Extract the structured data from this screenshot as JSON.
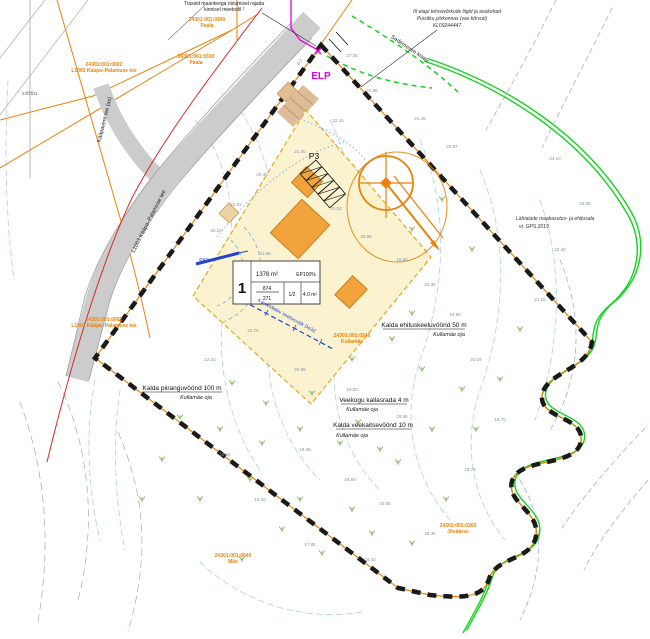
{
  "colors": {
    "cadastral_orange": "#E8820C",
    "boundary_black": "#1A1A1A",
    "plot_yellow": "#FBF3D0",
    "road_gray": "#CCCCCC",
    "stream_green": "#12D41F",
    "utility_blue": "#2244CC",
    "survey_magenta": "#E400E4",
    "protection_red": "#D42A2A",
    "contour_cyan": "#B5D6E6"
  },
  "plot_table": {
    "pos": "1",
    "area": "1378 m²",
    "ep": "EP100%",
    "frac_top": "874",
    "frac_bottom": "271",
    "floors": "1/2",
    "height": "4.0 m²"
  },
  "labels": [
    {
      "id": "note-crossing-line1",
      "t": "Trassid maanteega ristumisel rajada",
      "x": 224,
      "y": 5,
      "cls": "t-note"
    },
    {
      "id": "note-crossing-line2",
      "t": "kinnisel meetodil !",
      "x": 224,
      "y": 11,
      "cls": "t-note"
    },
    {
      "id": "note-utilities-line1",
      "t": "III etapi tehnovõrkude liigid ja asukohad",
      "x": 457,
      "y": 13,
      "cls": "t-noteit"
    },
    {
      "id": "note-utilities-line2",
      "t": "Puistiku piirkonnas (vas kõrvuti)",
      "x": 452,
      "y": 20,
      "cls": "t-noteit"
    },
    {
      "id": "note-utilities-line3",
      "t": "KL09244447",
      "x": 447,
      "y": 27,
      "cls": "t-noteit"
    },
    {
      "id": "cad-paala-1-code",
      "t": "24301:001:0300",
      "x": 207,
      "y": 21,
      "cls": "t-cad"
    },
    {
      "id": "cad-paala-1-name",
      "t": "Paala",
      "x": 207,
      "y": 27,
      "cls": "t-cad"
    },
    {
      "id": "cad-paala-2-code",
      "t": "24301:001:0310",
      "x": 196,
      "y": 58,
      "cls": "t-cad"
    },
    {
      "id": "cad-paala-2-name",
      "t": "Paala",
      "x": 196,
      "y": 64,
      "cls": "t-cad"
    },
    {
      "id": "cad-road-top-code",
      "t": "24301:001:0002",
      "x": 104,
      "y": 66,
      "cls": "t-cad"
    },
    {
      "id": "cad-road-top-name",
      "t": "L1003 Kääpa–Palamuse tee",
      "x": 104,
      "y": 72,
      "cls": "t-cad"
    },
    {
      "id": "cad-road-mid-code",
      "t": "24301:001:0002",
      "x": 104,
      "y": 321,
      "cls": "t-cad"
    },
    {
      "id": "cad-road-mid-name",
      "t": "L1003 Kääpa–Palamuse tee",
      "x": 104,
      "y": 327,
      "cls": "t-cad"
    },
    {
      "id": "cad-kullamae-code",
      "t": "24301:001:0246",
      "x": 352,
      "y": 337,
      "cls": "t-cad"
    },
    {
      "id": "cad-kullamae-name",
      "t": "Kullamäe",
      "x": 352,
      "y": 343,
      "cls": "t-cad"
    },
    {
      "id": "cad-mae-code",
      "t": "24301:001:0040",
      "x": 233,
      "y": 557,
      "cls": "t-cad"
    },
    {
      "id": "cad-mae-name",
      "t": "Mäe",
      "x": 233,
      "y": 563,
      "cls": "t-cad"
    },
    {
      "id": "cad-joeaarse-code",
      "t": "24301:001:0260",
      "x": 458,
      "y": 527,
      "cls": "t-cad"
    },
    {
      "id": "cad-joeaarse-name",
      "t": "Jõeäärse",
      "x": 458,
      "y": 533,
      "cls": "t-cad"
    },
    {
      "id": "zone-piirang-label",
      "t": "Kalda piiranguvöönd 100 m",
      "x": 182,
      "y": 390,
      "cls": "t-zone"
    },
    {
      "id": "zone-piirang-sub",
      "t": "Kullamäe oja",
      "x": 196,
      "y": 399,
      "cls": "t-zoneit"
    },
    {
      "id": "zone-ehituskeeld-label",
      "t": "Kalda ehituskeeluvöönd 50 m",
      "x": 424,
      "y": 327,
      "cls": "t-zone"
    },
    {
      "id": "zone-ehituskeeld-sub",
      "t": "Kullamäe oja",
      "x": 449,
      "y": 336,
      "cls": "t-zoneit"
    },
    {
      "id": "zone-kallasrada-label",
      "t": "Veekogu kallasrada 4 m",
      "x": 374,
      "y": 402,
      "cls": "t-zone"
    },
    {
      "id": "zone-kallasrada-sub",
      "t": "Kullamäe oja",
      "x": 362,
      "y": 411,
      "cls": "t-zoneit"
    },
    {
      "id": "zone-veekaitse-label",
      "t": "Kalda veekaitsevöönd 10 m",
      "x": 373,
      "y": 427,
      "cls": "t-zone"
    },
    {
      "id": "zone-veekaitse-sub",
      "t": "Kullamäe oja",
      "x": 352,
      "y": 437,
      "cls": "t-zoneit"
    },
    {
      "id": "note-adjacent-line1",
      "t": "Lähialade maakasutus- ja ehitusala",
      "x": 516,
      "y": 220,
      "cls": "t-noteit",
      "anchor": "start"
    },
    {
      "id": "note-adjacent-line2",
      "t": "vt. GPS.2019",
      "x": 519,
      "y": 228,
      "cls": "t-noteit",
      "anchor": "start"
    },
    {
      "id": "label-elp",
      "t": "ELP",
      "x": 321,
      "y": 79,
      "cls": "t-elp"
    },
    {
      "id": "label-p3",
      "t": "P3",
      "x": 314,
      "y": 159,
      "cls": "t-p3"
    },
    {
      "id": "label-pk3",
      "t": "PK3",
      "x": 204,
      "y": 262,
      "cls": "t-blue"
    },
    {
      "id": "road-name-kaapavere",
      "t": "Kääpavere tee (as)",
      "x": 106,
      "y": 120,
      "cls": "t-road",
      "r": -76
    },
    {
      "id": "road-name-l1003",
      "t": "L1003 Kääpa–Palamuse tee",
      "x": 150,
      "y": 222,
      "cls": "t-road",
      "r": -63
    },
    {
      "id": "pipe-veetorustik",
      "t": "Kavandatav veetorustik De32",
      "x": 286,
      "y": 317,
      "cls": "t-blue",
      "r": 29
    },
    {
      "id": "ditch-sademevee",
      "t": "Sademevee kraav",
      "x": 409,
      "y": 50,
      "cls": "t-road",
      "r": 34
    },
    {
      "id": "dim-07",
      "t": "0.7",
      "x": 301,
      "y": 63,
      "cls": "t-dim",
      "r": -47
    },
    {
      "id": "survey-ref",
      "t": "24/1511",
      "x": 22,
      "y": 95,
      "cls": "t-dim",
      "anchor": "start"
    }
  ],
  "spot_heights": [
    [
      27.35,
      352,
      57
    ],
    [
      21.96,
      372,
      92
    ],
    [
      21.45,
      420,
      120
    ],
    [
      20.87,
      452,
      148
    ],
    [
      22.15,
      338,
      122
    ],
    [
      21.3,
      300,
      153
    ],
    [
      20.45,
      262,
      176
    ],
    [
      21.62,
      236,
      206
    ],
    [
      20.12,
      216,
      232
    ],
    [
      21.02,
      336,
      210
    ],
    [
      20.66,
      366,
      238
    ],
    [
      19.85,
      402,
      261
    ],
    [
      20.3,
      430,
      286
    ],
    [
      19.56,
      455,
      316
    ],
    [
      21.75,
      253,
      332
    ],
    [
      22.31,
      210,
      361
    ],
    [
      20.95,
      300,
      371
    ],
    [
      19.2,
      352,
      391
    ],
    [
      18.95,
      402,
      418
    ],
    [
      19.45,
      305,
      451
    ],
    [
      18.6,
      350,
      481
    ],
    [
      18.2,
      260,
      501
    ],
    [
      19.02,
      225,
      456
    ],
    [
      17.85,
      310,
      546
    ],
    [
      18.42,
      370,
      561
    ],
    [
      20.18,
      476,
      361
    ],
    [
      19.7,
      500,
      421
    ],
    [
      18.75,
      470,
      471
    ],
    [
      21.15,
      540,
      301
    ],
    [
      22.4,
      560,
      251
    ],
    [
      23.05,
      585,
      205
    ],
    [
      24.1,
      555,
      160
    ],
    [
      20.55,
      385,
      505
    ],
    [
      19.35,
      430,
      535
    ],
    [
      21.88,
      265,
      255
    ]
  ],
  "vegetation_marks": [
    [
      180,
      420
    ],
    [
      220,
      432
    ],
    [
      262,
      446
    ],
    [
      300,
      432
    ],
    [
      340,
      446
    ],
    [
      380,
      452
    ],
    [
      250,
      482
    ],
    [
      200,
      502
    ],
    [
      300,
      502
    ],
    [
      352,
      512
    ],
    [
      282,
      532
    ],
    [
      322,
      556
    ],
    [
      242,
      562
    ],
    [
      372,
      536
    ],
    [
      412,
      546
    ],
    [
      162,
      462
    ],
    [
      142,
      502
    ],
    [
      432,
      432
    ],
    [
      462,
      392
    ],
    [
      422,
      372
    ],
    [
      392,
      342
    ],
    [
      352,
      362
    ],
    [
      312,
      396
    ],
    [
      266,
      406
    ],
    [
      446,
      502
    ],
    [
      476,
      432
    ],
    [
      412,
      316
    ],
    [
      232,
      386
    ],
    [
      500,
      382
    ],
    [
      520,
      332
    ],
    [
      412,
      232
    ],
    [
      442,
      202
    ],
    [
      472,
      252
    ],
    [
      358,
      425
    ],
    [
      398,
      465
    ]
  ]
}
